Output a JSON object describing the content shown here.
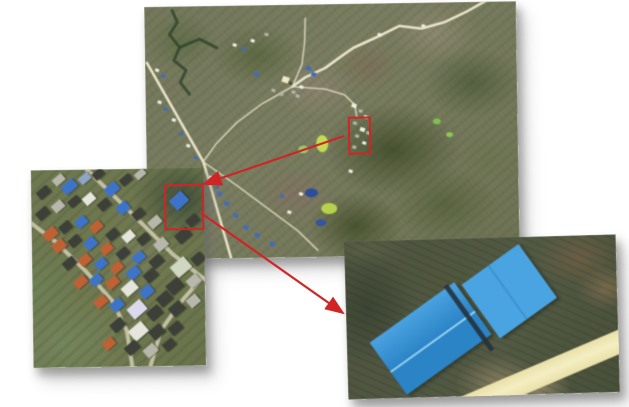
{
  "figure": {
    "title": "Multi-scale aerial zoom figure",
    "description": "Satellite overview with two red regions of interest; arrows lead to a village inset and to a close-up of two blue-roofed warehouse buildings.",
    "background": "#ffffff"
  },
  "colors": {
    "annotation_red": "#d02525",
    "road_major": "#e8e3c8",
    "road_minor": "#d9d5b9",
    "village_road": "#ccc8ac",
    "stream": "#31472e",
    "roof": {
      "d": "#3c4038",
      "b": "#3d74c9",
      "lb": "#6f9bd6",
      "o": "#bf6134",
      "w": "#e5e5dc",
      "g": "#b7b8ab",
      "gb": "#8ea6c4",
      "pw": "#dcd9ee",
      "pg": "#cfd6c2"
    },
    "marker": {
      "w": "#eceee4",
      "b": "#3f6cc0",
      "g": "#b5b5a6",
      "d": "#4c5240",
      "y": "#efe9c8"
    },
    "warehouse_left_light": "#4aa2e0",
    "warehouse_left_dark": "#2b84c6",
    "warehouse_right": "#4ba4e2",
    "warehouse_ridge": "#9ed7f2",
    "warehouse_seam": "#3a8fcd",
    "warehouse_gap": "#26313b",
    "dirt_road_edge": "#e9e0a8",
    "dirt_road_center": "#f4eec2"
  },
  "panels": {
    "overview": {
      "label": "overview satellite image",
      "x": 146,
      "y": 4,
      "w": 372,
      "h": 253,
      "rot": -0.9,
      "z": 1
    },
    "village": {
      "label": "village zoom inset",
      "x": 32,
      "y": 169,
      "w": 173,
      "h": 198,
      "rot": -0.8,
      "z": 2
    },
    "closeup": {
      "label": "blue warehouse close-up inset",
      "x": 346,
      "y": 238,
      "w": 272,
      "h": 158,
      "rot": -1.6,
      "z": 3
    }
  },
  "overview": {
    "roi": {
      "x": 202,
      "y": 113,
      "w": 19,
      "h": 34
    },
    "roads_major": [
      [
        [
          2,
          56
        ],
        [
          57,
          156
        ],
        [
          73,
          215
        ],
        [
          83,
          252
        ]
      ],
      [
        [
          344,
          -2
        ],
        [
          322,
          10
        ],
        [
          300,
          20
        ],
        [
          277,
          26
        ],
        [
          255,
          23
        ],
        [
          232,
          34
        ],
        [
          209,
          44
        ],
        [
          200,
          50
        ],
        [
          180,
          64
        ],
        [
          160,
          73
        ],
        [
          147,
          82
        ]
      ]
    ],
    "roads_minor": [
      [
        [
          147,
          82
        ],
        [
          116,
          99
        ],
        [
          91,
          117
        ],
        [
          70,
          138
        ],
        [
          58,
          154
        ]
      ],
      [
        [
          147,
          82
        ],
        [
          180,
          85
        ],
        [
          199,
          91
        ],
        [
          209,
          101
        ],
        [
          211,
          113
        ]
      ],
      [
        [
          57,
          156
        ],
        [
          90,
          180
        ],
        [
          120,
          203
        ],
        [
          150,
          226
        ],
        [
          170,
          246
        ]
      ],
      [
        [
          147,
          82
        ],
        [
          157,
          60
        ],
        [
          160,
          38
        ],
        [
          161,
          14
        ]
      ]
    ],
    "streams": [
      [
        [
          28,
          4
        ],
        [
          33,
          16
        ],
        [
          25,
          28
        ],
        [
          35,
          41
        ],
        [
          29,
          54
        ],
        [
          41,
          64
        ],
        [
          35,
          76
        ],
        [
          44,
          88
        ]
      ],
      [
        [
          35,
          41
        ],
        [
          55,
          33
        ],
        [
          72,
          42
        ]
      ]
    ],
    "patches": [
      [
        158,
        184,
        13,
        9,
        "#2c4e9c"
      ],
      [
        168,
        215,
        11,
        7,
        "#35559f"
      ],
      [
        174,
        199,
        16,
        11,
        "#b6d14e"
      ],
      [
        170,
        131,
        12,
        17,
        "#c3db52"
      ],
      [
        152,
        141,
        10,
        8,
        "#9dc468"
      ],
      [
        287,
        116,
        8,
        6,
        "#7ec24e"
      ],
      [
        300,
        130,
        7,
        5,
        "#8cc855"
      ]
    ],
    "buildings": [
      [
        137,
        72,
        7,
        "y"
      ],
      [
        161,
        62,
        5,
        "b"
      ],
      [
        166,
        68,
        5,
        "b"
      ],
      [
        109,
        67,
        5,
        "b"
      ],
      [
        126,
        84,
        4,
        "g"
      ],
      [
        134,
        88,
        4,
        "g"
      ],
      [
        146,
        86,
        4,
        "g"
      ],
      [
        154,
        81,
        4,
        "w"
      ],
      [
        150,
        90,
        4,
        "g"
      ],
      [
        143,
        77,
        4,
        "d"
      ],
      [
        88,
        38,
        4,
        "w"
      ],
      [
        97,
        42,
        4,
        "b"
      ],
      [
        106,
        34,
        4,
        "w"
      ],
      [
        120,
        28,
        4,
        "g"
      ],
      [
        206,
        100,
        5,
        "w"
      ],
      [
        213,
        106,
        4,
        "g"
      ],
      [
        218,
        112,
        4,
        "w"
      ],
      [
        207,
        118,
        4,
        "g"
      ],
      [
        214,
        124,
        5,
        "w"
      ],
      [
        209,
        131,
        4,
        "g"
      ],
      [
        216,
        138,
        4,
        "w"
      ],
      [
        206,
        142,
        4,
        "g"
      ],
      [
        220,
        128,
        4,
        "g"
      ],
      [
        10,
        62,
        4,
        "w"
      ],
      [
        16,
        68,
        4,
        "b"
      ],
      [
        12,
        94,
        4,
        "w"
      ],
      [
        18,
        101,
        4,
        "b"
      ],
      [
        26,
        112,
        4,
        "w"
      ],
      [
        33,
        126,
        4,
        "b"
      ],
      [
        40,
        138,
        4,
        "w"
      ],
      [
        47,
        150,
        4,
        "b"
      ],
      [
        62,
        170,
        4,
        "w"
      ],
      [
        68,
        180,
        4,
        "b"
      ],
      [
        70,
        186,
        5,
        "b"
      ],
      [
        77,
        196,
        5,
        "b"
      ],
      [
        86,
        208,
        5,
        "b"
      ],
      [
        96,
        220,
        5,
        "b"
      ],
      [
        107,
        228,
        5,
        "b"
      ],
      [
        122,
        237,
        5,
        "b"
      ],
      [
        140,
        206,
        4,
        "w"
      ],
      [
        152,
        188,
        4,
        "w"
      ],
      [
        133,
        190,
        4,
        "b"
      ],
      [
        277,
        22,
        4,
        "w"
      ],
      [
        233,
        30,
        4,
        "w"
      ],
      [
        202,
        166,
        4,
        "w"
      ]
    ]
  },
  "village": {
    "roi": {
      "x": 133,
      "y": 16,
      "w": 36,
      "h": 42
    },
    "roads": [
      [
        [
          52,
          -4
        ],
        [
          96,
          40
        ],
        [
          141,
          86
        ],
        [
          173,
          112
        ]
      ],
      [
        [
          170,
          110
        ],
        [
          150,
          132
        ],
        [
          128,
          162
        ],
        [
          117,
          198
        ]
      ],
      [
        [
          -4,
          50
        ],
        [
          24,
          72
        ],
        [
          54,
          102
        ],
        [
          80,
          132
        ],
        [
          94,
          162
        ],
        [
          99,
          198
        ]
      ]
    ],
    "houses": [
      [
        22,
        6,
        12,
        8,
        -40,
        "g"
      ],
      [
        31,
        12,
        15,
        10,
        -40,
        "b"
      ],
      [
        48,
        5,
        12,
        8,
        -40,
        "gb"
      ],
      [
        62,
        1,
        11,
        8,
        -40,
        "d"
      ],
      [
        74,
        15,
        14,
        10,
        -40,
        "b"
      ],
      [
        89,
        7,
        12,
        8,
        -40,
        "d"
      ],
      [
        104,
        2,
        11,
        7,
        -40,
        "g"
      ],
      [
        6,
        18,
        13,
        9,
        -40,
        "d"
      ],
      [
        140,
        26,
        16,
        13,
        -42,
        "b"
      ],
      [
        155,
        48,
        12,
        9,
        -40,
        "d"
      ],
      [
        5,
        39,
        13,
        9,
        -40,
        "d"
      ],
      [
        21,
        32,
        12,
        9,
        -40,
        "g"
      ],
      [
        37,
        28,
        12,
        8,
        -40,
        "d"
      ],
      [
        52,
        25,
        12,
        9,
        -40,
        "w"
      ],
      [
        67,
        31,
        12,
        9,
        -40,
        "d"
      ],
      [
        86,
        34,
        12,
        10,
        -42,
        "b"
      ],
      [
        101,
        41,
        12,
        9,
        -40,
        "d"
      ],
      [
        117,
        49,
        13,
        9,
        -40,
        "g"
      ],
      [
        12,
        59,
        14,
        10,
        -40,
        "o"
      ],
      [
        28,
        53,
        12,
        9,
        -40,
        "d"
      ],
      [
        44,
        48,
        12,
        9,
        -40,
        "b"
      ],
      [
        59,
        53,
        12,
        9,
        -40,
        "o"
      ],
      [
        75,
        61,
        12,
        9,
        -40,
        "d"
      ],
      [
        91,
        63,
        12,
        9,
        -40,
        "w"
      ],
      [
        106,
        66,
        12,
        9,
        -40,
        "d"
      ],
      [
        123,
        71,
        13,
        10,
        -40,
        "g"
      ],
      [
        144,
        62,
        15,
        11,
        -40,
        "d"
      ],
      [
        21,
        71,
        13,
        10,
        -40,
        "o"
      ],
      [
        37,
        67,
        12,
        9,
        -40,
        "d"
      ],
      [
        53,
        69,
        12,
        10,
        -40,
        "b"
      ],
      [
        69,
        75,
        12,
        9,
        -40,
        "o"
      ],
      [
        85,
        80,
        12,
        9,
        -40,
        "d"
      ],
      [
        101,
        84,
        12,
        9,
        -40,
        "b"
      ],
      [
        118,
        88,
        13,
        10,
        -40,
        "d"
      ],
      [
        140,
        92,
        18,
        14,
        -40,
        "pg"
      ],
      [
        160,
        86,
        12,
        10,
        -40,
        "d"
      ],
      [
        31,
        89,
        13,
        9,
        -40,
        "d"
      ],
      [
        47,
        86,
        12,
        9,
        -40,
        "o"
      ],
      [
        63,
        90,
        12,
        9,
        -40,
        "b"
      ],
      [
        79,
        94,
        12,
        9,
        -40,
        "o"
      ],
      [
        95,
        99,
        13,
        10,
        -40,
        "b"
      ],
      [
        112,
        102,
        13,
        10,
        -40,
        "d"
      ],
      [
        135,
        112,
        15,
        12,
        -40,
        "d"
      ],
      [
        155,
        108,
        13,
        10,
        -40,
        "g"
      ],
      [
        42,
        108,
        13,
        9,
        -40,
        "o"
      ],
      [
        58,
        106,
        12,
        9,
        -40,
        "b"
      ],
      [
        74,
        109,
        13,
        9,
        -40,
        "o"
      ],
      [
        90,
        114,
        15,
        11,
        -40,
        "w"
      ],
      [
        108,
        118,
        13,
        10,
        -40,
        "b"
      ],
      [
        125,
        125,
        14,
        11,
        -40,
        "d"
      ],
      [
        62,
        128,
        13,
        9,
        -40,
        "o"
      ],
      [
        78,
        131,
        13,
        10,
        -40,
        "b"
      ],
      [
        96,
        134,
        17,
        13,
        -40,
        "pw"
      ],
      [
        115,
        139,
        14,
        11,
        -40,
        "d"
      ],
      [
        137,
        135,
        14,
        11,
        -40,
        "d"
      ],
      [
        155,
        128,
        12,
        10,
        -40,
        "g"
      ],
      [
        78,
        151,
        14,
        10,
        -40,
        "d"
      ],
      [
        97,
        156,
        17,
        13,
        -40,
        "w"
      ],
      [
        117,
        158,
        14,
        11,
        -40,
        "d"
      ],
      [
        136,
        155,
        13,
        10,
        -40,
        "d"
      ],
      [
        70,
        170,
        12,
        9,
        -40,
        "o"
      ],
      [
        92,
        174,
        14,
        10,
        -40,
        "d"
      ],
      [
        111,
        177,
        13,
        10,
        -40,
        "g"
      ],
      [
        130,
        172,
        12,
        9,
        -40,
        "d"
      ]
    ]
  },
  "closeup": {
    "warehouse_left": {
      "cx": 84,
      "cy": 99,
      "w": 104,
      "h": 64,
      "rot": -34
    },
    "warehouse_right": {
      "cx": 164,
      "cy": 54,
      "w": 70,
      "h": 66,
      "rot": -34
    },
    "gap": {
      "cx": 123,
      "cy": 79,
      "w": 80,
      "h": 5,
      "rot": 56
    },
    "dirt_road": {
      "cx": 204,
      "cy": 134,
      "w": 200,
      "h": 23,
      "rot": -21.5
    }
  },
  "arrows": [
    {
      "from": [
        344,
        136
      ],
      "to": [
        204,
        184
      ]
    },
    {
      "from": [
        201,
        213
      ],
      "to": [
        343,
        313
      ]
    }
  ]
}
